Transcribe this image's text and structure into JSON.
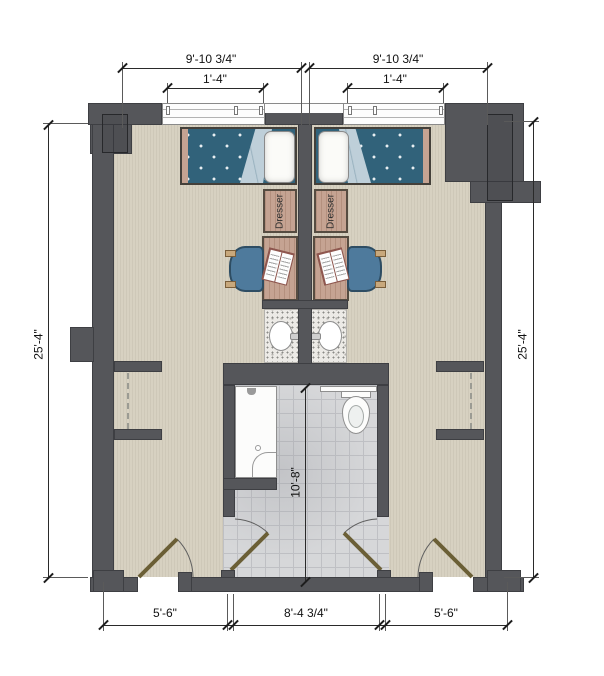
{
  "plan": {
    "title": "double-occupancy residence room floor plan",
    "dimensions": {
      "top_left": "9'-10 3/4\"",
      "top_right": "9'-10 3/4\"",
      "window_left": "1'-4\"",
      "window_right": "1'-4\"",
      "side_left": "25'-4\"",
      "side_right": "25'-4\"",
      "bath": "10'-8\"",
      "bottom_left": "5'-6\"",
      "bottom_center": "8'-4 3/4\"",
      "bottom_right": "5'-6\""
    },
    "furniture": {
      "dresser_left": "Dresser",
      "dresser_right": "Dresser"
    },
    "colors": {
      "wall": "#55565a",
      "floor": "#d7d1c1",
      "tile": "#d6d7d9",
      "duvet": "#31627a",
      "blanket": "#becfd9",
      "wood": "#c5a392",
      "chair": "#4e7a9c",
      "door": "#6b5f36"
    }
  }
}
